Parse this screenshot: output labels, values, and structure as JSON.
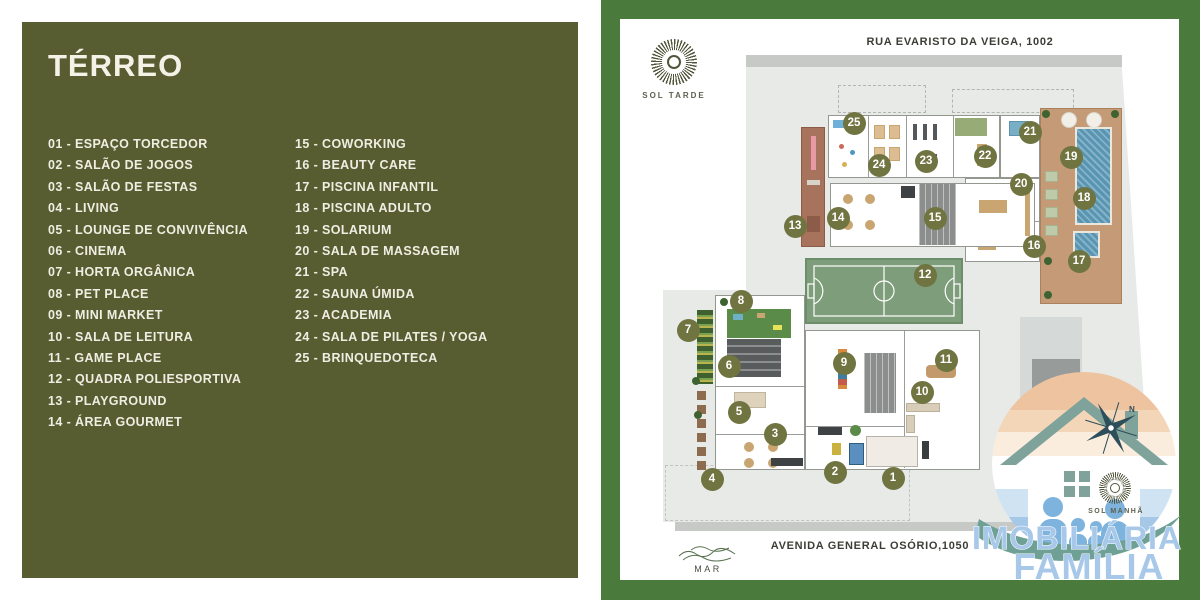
{
  "legend": {
    "title": "TÉRREO",
    "col1": [
      {
        "num": "01",
        "label": "ESPAÇO TORCEDOR"
      },
      {
        "num": "02",
        "label": "SALÃO DE JOGOS"
      },
      {
        "num": "03",
        "label": "SALÃO DE FESTAS"
      },
      {
        "num": "04",
        "label": "LIVING"
      },
      {
        "num": "05",
        "label": "LOUNGE DE CONVIVÊNCIA"
      },
      {
        "num": "06",
        "label": "CINEMA"
      },
      {
        "num": "07",
        "label": "HORTA ORGÂNICA"
      },
      {
        "num": "08",
        "label": "PET PLACE"
      },
      {
        "num": "09",
        "label": "MINI MARKET"
      },
      {
        "num": "10",
        "label": "SALA DE LEITURA"
      },
      {
        "num": "11",
        "label": "GAME PLACE"
      },
      {
        "num": "12",
        "label": "QUADRA POLIESPORTIVA"
      },
      {
        "num": "13",
        "label": "PLAYGROUND"
      },
      {
        "num": "14",
        "label": "ÁREA GOURMET"
      }
    ],
    "col2": [
      {
        "num": "15",
        "label": "COWORKING"
      },
      {
        "num": "16",
        "label": "BEAUTY CARE"
      },
      {
        "num": "17",
        "label": "PISCINA INFANTIL"
      },
      {
        "num": "18",
        "label": "PISCINA ADULTO"
      },
      {
        "num": "19",
        "label": "SOLARIUM"
      },
      {
        "num": "20",
        "label": "SALA DE MASSAGEM"
      },
      {
        "num": "21",
        "label": "SPA"
      },
      {
        "num": "22",
        "label": "SAUNA ÚMIDA"
      },
      {
        "num": "23",
        "label": "ACADEMIA"
      },
      {
        "num": "24",
        "label": "SALA DE PILATES / YOGA"
      },
      {
        "num": "25",
        "label": "BRINQUEDOTECA"
      }
    ]
  },
  "plan": {
    "street_top": "RUA EVARISTO DA VEIGA, 1002",
    "street_bottom": "AVENIDA GENERAL OSÓRIO,1050",
    "sea_label": "MAR",
    "sun_afternoon_label": "SOL TARDE",
    "sun_morning_label": "SOL MANHÃ",
    "compass_north": "N",
    "markers": [
      {
        "n": "1",
        "x": 273,
        "y": 459
      },
      {
        "n": "2",
        "x": 215,
        "y": 453
      },
      {
        "n": "3",
        "x": 155,
        "y": 415
      },
      {
        "n": "4",
        "x": 92,
        "y": 460
      },
      {
        "n": "5",
        "x": 119,
        "y": 393
      },
      {
        "n": "6",
        "x": 109,
        "y": 347
      },
      {
        "n": "7",
        "x": 68,
        "y": 311
      },
      {
        "n": "8",
        "x": 121,
        "y": 282
      },
      {
        "n": "9",
        "x": 224,
        "y": 344
      },
      {
        "n": "10",
        "x": 302,
        "y": 373
      },
      {
        "n": "11",
        "x": 326,
        "y": 341
      },
      {
        "n": "12",
        "x": 305,
        "y": 256
      },
      {
        "n": "13",
        "x": 175,
        "y": 207
      },
      {
        "n": "14",
        "x": 218,
        "y": 199
      },
      {
        "n": "15",
        "x": 315,
        "y": 199
      },
      {
        "n": "16",
        "x": 414,
        "y": 227
      },
      {
        "n": "17",
        "x": 459,
        "y": 242
      },
      {
        "n": "18",
        "x": 464,
        "y": 179
      },
      {
        "n": "19",
        "x": 451,
        "y": 138
      },
      {
        "n": "20",
        "x": 401,
        "y": 165
      },
      {
        "n": "21",
        "x": 410,
        "y": 113
      },
      {
        "n": "22",
        "x": 365,
        "y": 137
      },
      {
        "n": "23",
        "x": 306,
        "y": 142
      },
      {
        "n": "24",
        "x": 259,
        "y": 146
      },
      {
        "n": "25",
        "x": 234,
        "y": 104
      }
    ]
  },
  "watermark": {
    "line1": "IMOBILIÁRIA",
    "line2": "FAMÍLIA"
  },
  "colors": {
    "panel_olive": "#575c31",
    "background_green": "#4b7a3d",
    "marker_circle": "#6f7440",
    "legend_text": "#efeee2",
    "court_green": "#7e9d7b",
    "pool_blue": "#5795b2",
    "deck_tan": "#c49a77",
    "watermark_blue": "#a7c8e9"
  }
}
